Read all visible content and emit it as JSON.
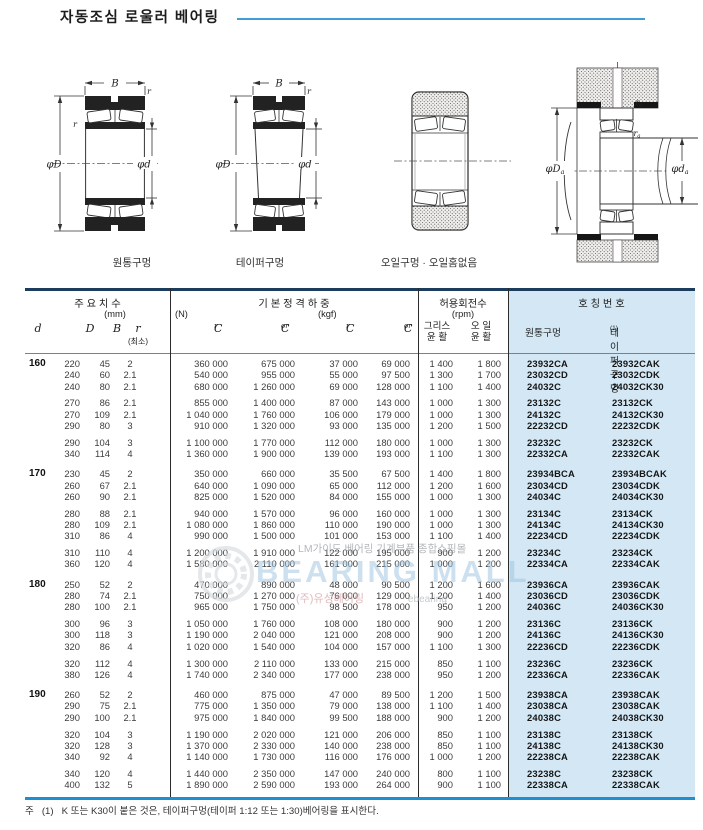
{
  "page": {
    "title": "자동조심 로울러 베어링",
    "note_mark": "주",
    "note_num": "(1)",
    "note_text": "K 또는 K30이 붙은 것은, 테이퍼구멍(테이퍼 1:12 또는 1:30)베어링을 표시한다."
  },
  "colors": {
    "accent_blue": "#3f9ed8",
    "table_top_border": "#1c3c5e",
    "table_bottom_border": "#1e8fd0",
    "highlight_bg": "#d3e8f4"
  },
  "drawings": {
    "captions": [
      "원통구멍",
      "테이퍼구멍",
      "오일구멍 · 오일홈없음"
    ],
    "dim": {
      "B": "B",
      "r": "r",
      "phiD": "φD",
      "phid": "φd",
      "suba": "a"
    }
  },
  "watermark": {
    "brand": "BEARING MALL",
    "top_text": "LM가이드 베어링 기계부품 종합쇼핑몰",
    "bottom_left": "(주)유성베어링",
    "bottom_right": "ebearing"
  },
  "table": {
    "headers": {
      "dims_title": "주 요 치 수",
      "dims_unit": "(mm)",
      "load_title": "기 본 정 격 하 중",
      "load_n": "(N)",
      "load_kgf": "(kgf)",
      "speed_title": "허용회전수",
      "speed_unit": "(rpm)",
      "number_title": "호 칭 번 호",
      "d": "d",
      "D": "D",
      "B": "B",
      "r": "r",
      "r_min": "(최소)",
      "C": "C",
      "sub_r": "r",
      "sub_or": "or",
      "grease1": "그리스",
      "grease2": "윤 활",
      "oil1": "오 일",
      "oil2": "윤 활",
      "cyl": "원통구멍",
      "taper": "테이퍼구멍",
      "taper_sup": "(1)"
    },
    "groups": [
      {
        "d": "160",
        "blocks": [
          [
            [
              "220",
              "45",
              "2",
              "360 000",
              "675 000",
              "37 000",
              "69 000",
              "1 400",
              "1 800",
              "23932CA",
              "23932CAK"
            ],
            [
              "240",
              "60",
              "2.1",
              "540 000",
              "955 000",
              "55 000",
              "97 500",
              "1 300",
              "1 700",
              "23032CD",
              "23032CDK"
            ],
            [
              "240",
              "80",
              "2.1",
              "680 000",
              "1 260 000",
              "69 000",
              "128 000",
              "1 100",
              "1 400",
              "24032C",
              "24032CK30"
            ]
          ],
          [
            [
              "270",
              "86",
              "2.1",
              "855 000",
              "1 400 000",
              "87 000",
              "143 000",
              "1 000",
              "1 300",
              "23132C",
              "23132CK"
            ],
            [
              "270",
              "109",
              "2.1",
              "1 040 000",
              "1 760 000",
              "106 000",
              "179 000",
              "1 000",
              "1 300",
              "24132C",
              "24132CK30"
            ],
            [
              "290",
              "80",
              "3",
              "910 000",
              "1 320 000",
              "93 000",
              "135 000",
              "1 200",
              "1 500",
              "22232CD",
              "22232CDK"
            ]
          ],
          [
            [
              "290",
              "104",
              "3",
              "1 100 000",
              "1 770 000",
              "112 000",
              "180 000",
              "1 000",
              "1 300",
              "23232C",
              "23232CK"
            ],
            [
              "340",
              "114",
              "4",
              "1 360 000",
              "1 900 000",
              "139 000",
              "193 000",
              "1 100",
              "1 300",
              "22332CA",
              "22332CAK"
            ]
          ]
        ]
      },
      {
        "d": "170",
        "blocks": [
          [
            [
              "230",
              "45",
              "2",
              "350 000",
              "660 000",
              "35 500",
              "67 500",
              "1 400",
              "1 800",
              "23934BCA",
              "23934BCAK"
            ],
            [
              "260",
              "67",
              "2.1",
              "640 000",
              "1 090 000",
              "65 000",
              "112 000",
              "1 200",
              "1 600",
              "23034CD",
              "23034CDK"
            ],
            [
              "260",
              "90",
              "2.1",
              "825 000",
              "1 520 000",
              "84 000",
              "155 000",
              "1 000",
              "1 300",
              "24034C",
              "24034CK30"
            ]
          ],
          [
            [
              "280",
              "88",
              "2.1",
              "940 000",
              "1 570 000",
              "96 000",
              "160 000",
              "1 000",
              "1 300",
              "23134C",
              "23134CK"
            ],
            [
              "280",
              "109",
              "2.1",
              "1 080 000",
              "1 860 000",
              "110 000",
              "190 000",
              "1 000",
              "1 300",
              "24134C",
              "24134CK30"
            ],
            [
              "310",
              "86",
              "4",
              "990 000",
              "1 500 000",
              "101 000",
              "153 000",
              "1 100",
              "1 400",
              "22234CD",
              "22234CDK"
            ]
          ],
          [
            [
              "310",
              "110",
              "4",
              "1 200 000",
              "1 910 000",
              "122 000",
              "195 000",
              "900",
              "1 200",
              "23234C",
              "23234CK"
            ],
            [
              "360",
              "120",
              "4",
              "1 580 000",
              "2 110 000",
              "161 000",
              "215 000",
              "1 000",
              "1 200",
              "22334CA",
              "22334CAK"
            ]
          ]
        ]
      },
      {
        "d": "180",
        "blocks": [
          [
            [
              "250",
              "52",
              "2",
              "470 000",
              "890 000",
              "48 000",
              "90 500",
              "1 200",
              "1 600",
              "23936CA",
              "23936CAK"
            ],
            [
              "280",
              "74",
              "2.1",
              "750 000",
              "1 270 000",
              "76 000",
              "129 000",
              "1 200",
              "1 400",
              "23036CD",
              "23036CDK"
            ],
            [
              "280",
              "100",
              "2.1",
              "965 000",
              "1 750 000",
              "98 500",
              "178 000",
              "950",
              "1 200",
              "24036C",
              "24036CK30"
            ]
          ],
          [
            [
              "300",
              "96",
              "3",
              "1 050 000",
              "1 760 000",
              "108 000",
              "180 000",
              "900",
              "1 200",
              "23136C",
              "23136CK"
            ],
            [
              "300",
              "118",
              "3",
              "1 190 000",
              "2 040 000",
              "121 000",
              "208 000",
              "900",
              "1 200",
              "24136C",
              "24136CK30"
            ],
            [
              "320",
              "86",
              "4",
              "1 020 000",
              "1 540 000",
              "104 000",
              "157 000",
              "1 100",
              "1 300",
              "22236CD",
              "22236CDK"
            ]
          ],
          [
            [
              "320",
              "112",
              "4",
              "1 300 000",
              "2 110 000",
              "133 000",
              "215 000",
              "850",
              "1 100",
              "23236C",
              "23236CK"
            ],
            [
              "380",
              "126",
              "4",
              "1 740 000",
              "2 340 000",
              "177 000",
              "238 000",
              "950",
              "1 200",
              "22336CA",
              "22336CAK"
            ]
          ]
        ]
      },
      {
        "d": "190",
        "blocks": [
          [
            [
              "260",
              "52",
              "2",
              "460 000",
              "875 000",
              "47 000",
              "89 500",
              "1 200",
              "1 500",
              "23938CA",
              "23938CAK"
            ],
            [
              "290",
              "75",
              "2.1",
              "775 000",
              "1 350 000",
              "79 000",
              "138 000",
              "1 100",
              "1 400",
              "23038CA",
              "23038CAK"
            ],
            [
              "290",
              "100",
              "2.1",
              "975 000",
              "1 840 000",
              "99 500",
              "188 000",
              "900",
              "1 200",
              "24038C",
              "24038CK30"
            ]
          ],
          [
            [
              "320",
              "104",
              "3",
              "1 190 000",
              "2 020 000",
              "121 000",
              "206 000",
              "850",
              "1 100",
              "23138C",
              "23138CK"
            ],
            [
              "320",
              "128",
              "3",
              "1 370 000",
              "2 330 000",
              "140 000",
              "238 000",
              "850",
              "1 100",
              "24138C",
              "24138CK30"
            ],
            [
              "340",
              "92",
              "4",
              "1 140 000",
              "1 730 000",
              "116 000",
              "176 000",
              "1 000",
              "1 200",
              "22238CA",
              "22238CAK"
            ]
          ],
          [
            [
              "340",
              "120",
              "4",
              "1 440 000",
              "2 350 000",
              "147 000",
              "240 000",
              "800",
              "1 100",
              "23238C",
              "23238CK"
            ],
            [
              "400",
              "132",
              "5",
              "1 890 000",
              "2 590 000",
              "193 000",
              "264 000",
              "900",
              "1 100",
              "22338CA",
              "22338CAK"
            ]
          ]
        ]
      }
    ]
  }
}
